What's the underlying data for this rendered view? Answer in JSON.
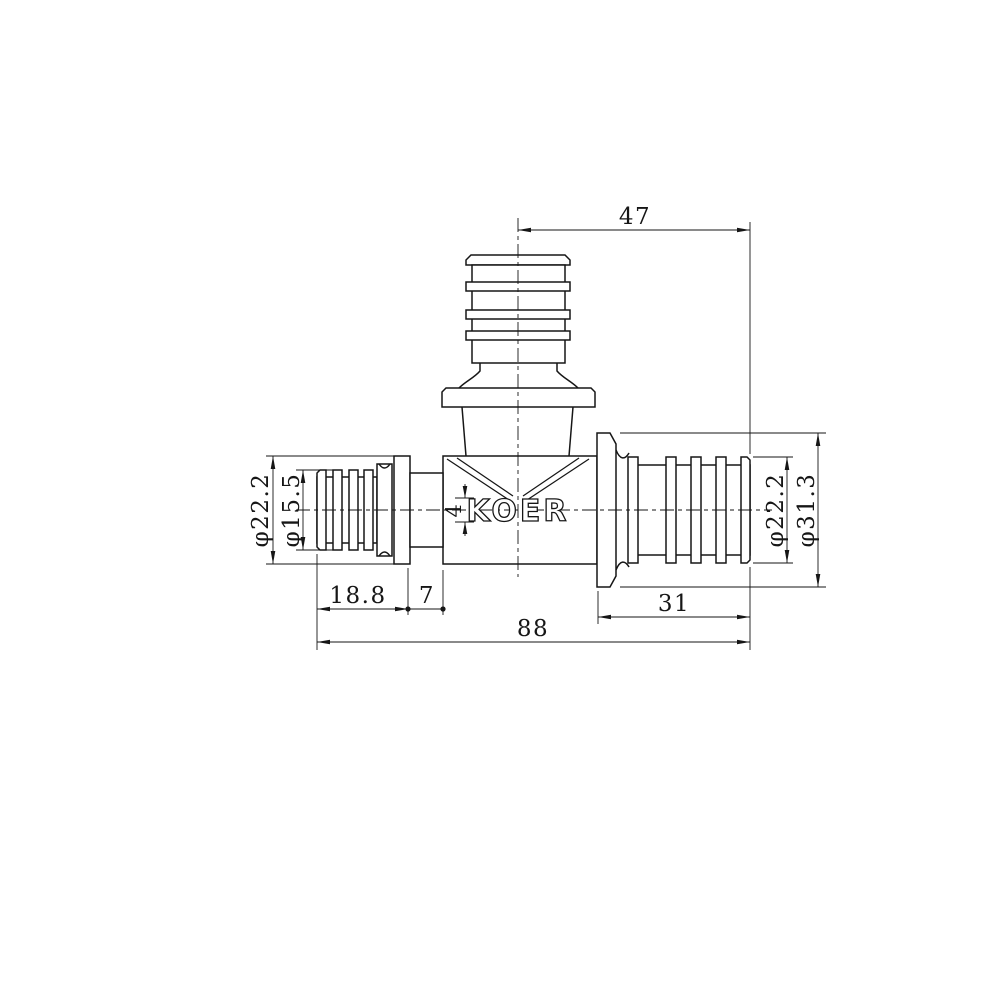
{
  "title": "Tee fitting technical drawing",
  "logo": "KOER",
  "dimensions": {
    "top_offset": "47",
    "overall_length": "88",
    "right_port_length": "31",
    "left_barb_length": "18.8",
    "left_gap": "7",
    "logo_band_height": "4",
    "left_flange_diameter": "φ22.2",
    "left_barb_diameter": "φ15.5",
    "right_barb_diameter": "φ22.2",
    "right_flange_diameter": "φ31.3"
  },
  "colors": {
    "line": "#161616",
    "background": "#ffffff"
  }
}
